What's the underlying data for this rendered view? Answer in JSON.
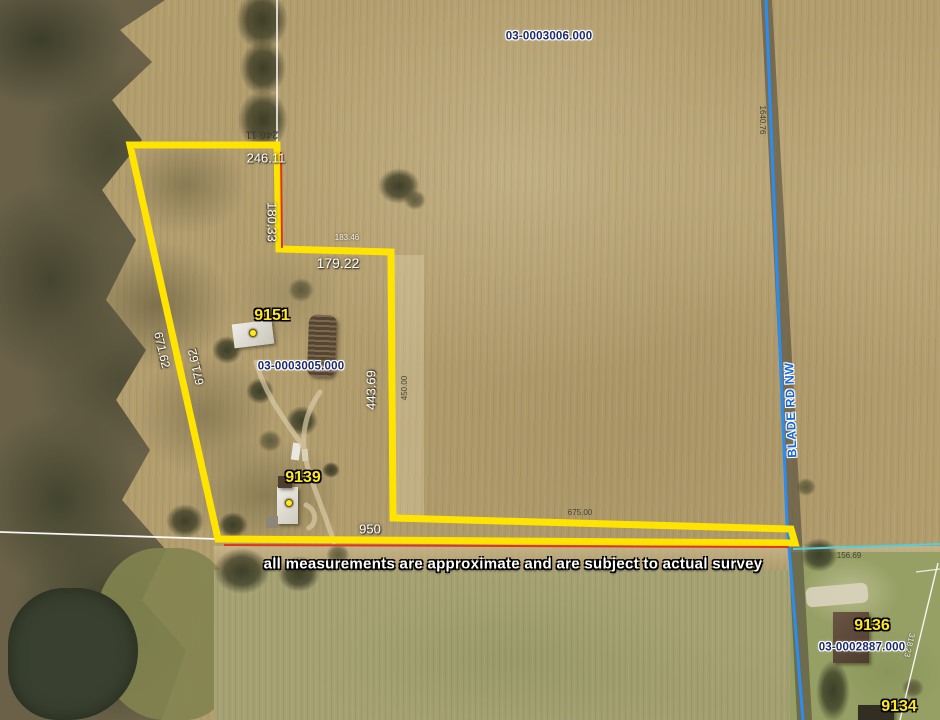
{
  "map": {
    "disclaimer": "all measurements are approximate and are subject to actual survey",
    "road_label": "BLADE RD NW",
    "parcel_ids": {
      "north": "03-0003006.000",
      "subject": "03-0003005.000",
      "southeast": "03-0002887.000"
    },
    "addresses": {
      "a9151": "9151",
      "a9139": "9139",
      "a9136": "9136",
      "a9134": "9134"
    },
    "measurements": {
      "top_edge_dark": "246.11",
      "top_edge": "246.11",
      "east_upper": "180.33",
      "jog_small": "183.46",
      "jog": "179.22",
      "east_lower": "443.69",
      "east_lower_alt": "450.00",
      "west_diagonal_a": "671.62",
      "west_diagonal_b": "671.62",
      "south_total": "950",
      "south_segment": "675.00",
      "road_frontage_north": "1640.76",
      "cyan_line": "156.69",
      "southeast_line": "318.23"
    },
    "colors": {
      "boundary": "#ffe400",
      "red_line": "#e0341f",
      "road_line": "#2b8df2",
      "cyan_line": "#4fd0dc",
      "section_line": "#ffffff",
      "parcel_id_text": "#1b2a6e",
      "address_text": "#ffe81e"
    }
  }
}
